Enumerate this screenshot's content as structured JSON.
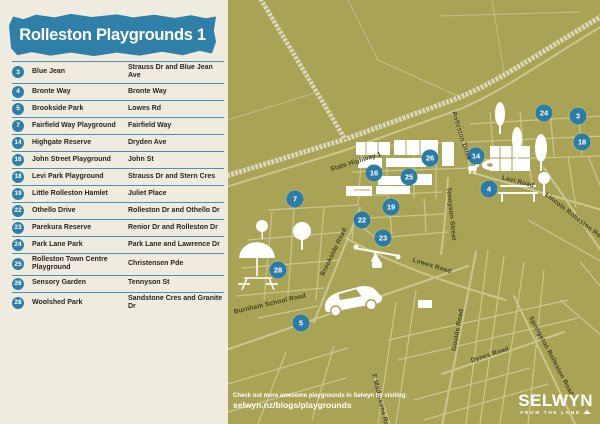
{
  "title": "Rolleston Playgrounds 1",
  "legend": {
    "rows": [
      {
        "num": "3",
        "name": "Blue Jean",
        "location": "Strauss Dr and Blue Jean Ave"
      },
      {
        "num": "4",
        "name": "Bronte Way",
        "location": "Bronte Way"
      },
      {
        "num": "5",
        "name": "Brookside Park",
        "location": "Lowes Rd"
      },
      {
        "num": "7",
        "name": "Fairfield Way Playground",
        "location": "Fairfield Way"
      },
      {
        "num": "14",
        "name": "Highgate Reserve",
        "location": "Dryden Ave"
      },
      {
        "num": "16",
        "name": "John Street Playground",
        "location": "John St"
      },
      {
        "num": "18",
        "name": "Levi Park Playground",
        "location": "Strauss Dr and Stern Cres"
      },
      {
        "num": "19",
        "name": "Little Rolleston Hamlet",
        "location": "Juliet Place"
      },
      {
        "num": "22",
        "name": "Othello Drive",
        "location": "Rolleston Dr and Othello Dr"
      },
      {
        "num": "23",
        "name": "Parekura Reserve",
        "location": "Renior Dr and Rolleston Dr"
      },
      {
        "num": "24",
        "name": "Park Lane Park",
        "location": "Park Lane and Lawrence Dr"
      },
      {
        "num": "25",
        "name": "Rolleston Town Centre Playground",
        "location": "Christensen Pde"
      },
      {
        "num": "26",
        "name": "Sensory Garden",
        "location": "Tennyson St"
      },
      {
        "num": "28",
        "name": "Woolshed Park",
        "location": "Sandstone Cres and Granite Dr"
      }
    ]
  },
  "map": {
    "markers": [
      {
        "num": "3",
        "x": 350,
        "y": 116
      },
      {
        "num": "4",
        "x": 261,
        "y": 189
      },
      {
        "num": "5",
        "x": 73,
        "y": 323
      },
      {
        "num": "7",
        "x": 67,
        "y": 199
      },
      {
        "num": "14",
        "x": 248,
        "y": 156
      },
      {
        "num": "16",
        "x": 146,
        "y": 173
      },
      {
        "num": "18",
        "x": 354,
        "y": 142
      },
      {
        "num": "19",
        "x": 163,
        "y": 207
      },
      {
        "num": "22",
        "x": 134,
        "y": 220
      },
      {
        "num": "23",
        "x": 155,
        "y": 238
      },
      {
        "num": "24",
        "x": 316,
        "y": 113
      },
      {
        "num": "25",
        "x": 181,
        "y": 177
      },
      {
        "num": "26",
        "x": 202,
        "y": 158
      },
      {
        "num": "28",
        "x": 50,
        "y": 270
      }
    ],
    "streets": [
      {
        "name": "State Highway 1",
        "x": 128,
        "y": 162,
        "rot": -17
      },
      {
        "name": "Rolleston Drive",
        "x": 233,
        "y": 136,
        "rot": 72
      },
      {
        "name": "Levi Road",
        "x": 290,
        "y": 182,
        "rot": 14
      },
      {
        "name": "Lincoln Rolleston Road",
        "x": 348,
        "y": 218,
        "rot": 38
      },
      {
        "name": "Tennyson Street",
        "x": 223,
        "y": 214,
        "rot": 84
      },
      {
        "name": "Brookside Road",
        "x": 106,
        "y": 252,
        "rot": -64
      },
      {
        "name": "Lowes Road",
        "x": 204,
        "y": 266,
        "rot": 17
      },
      {
        "name": "Burnham School Road",
        "x": 42,
        "y": 304,
        "rot": -13
      },
      {
        "name": "Goulds Road",
        "x": 230,
        "y": 330,
        "rot": -80
      },
      {
        "name": "Dynes Road",
        "x": 262,
        "y": 355,
        "rot": -18
      },
      {
        "name": "Springston Rolleston Road",
        "x": 323,
        "y": 356,
        "rot": 62
      },
      {
        "name": "E Maddisons Rd",
        "x": 152,
        "y": 400,
        "rot": 76
      }
    ],
    "footer_line1": "Check out more awesome playgrounds in Selwyn by visiting:",
    "footer_line2": "selwyn.nz/blogs/playgrounds",
    "logo_main": "SELWYN",
    "logo_sub": "FROM THE LAND"
  },
  "colors": {
    "blue": "#2e80a8",
    "beige": "#f0ebdf",
    "olive": "#a9a455",
    "road": "#cbc68c",
    "rail_base": "#ddd8b0",
    "rail_ties": "#6f6b3a",
    "map_label": "#44402a",
    "legend_text": "#26261e",
    "white": "#ffffff"
  }
}
